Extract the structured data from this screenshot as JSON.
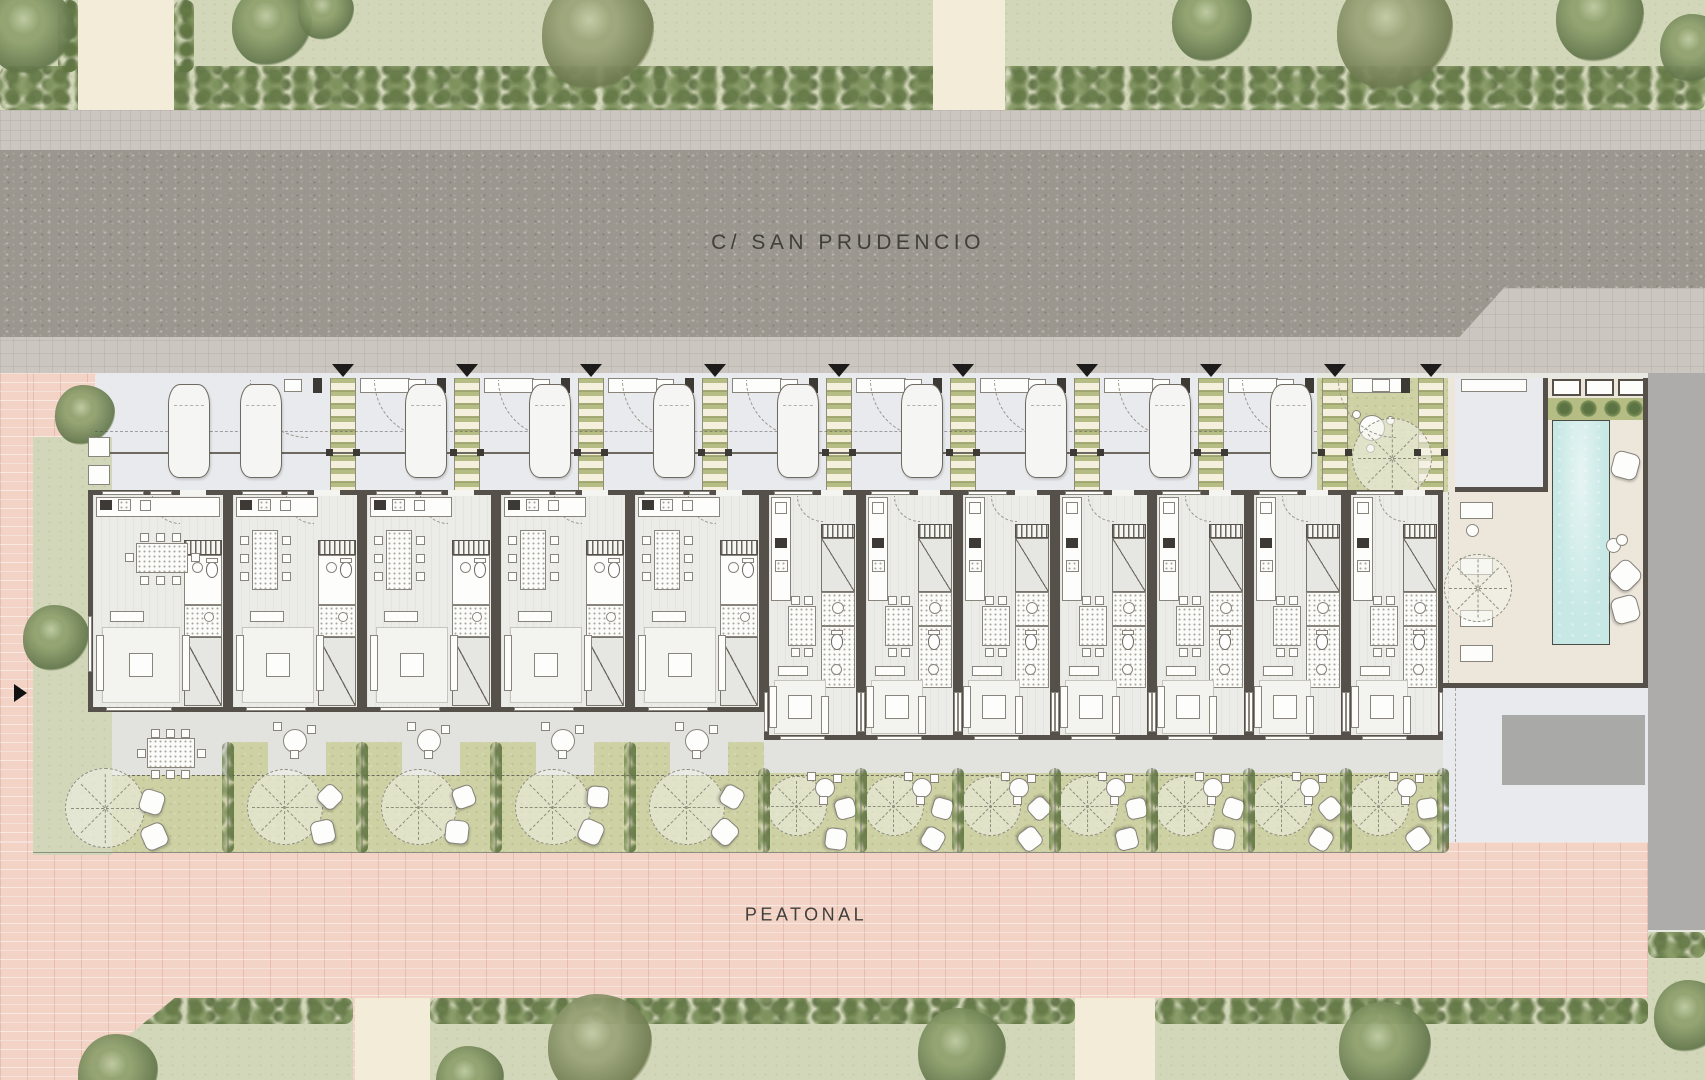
{
  "labels": {
    "street": "C/ SAN PRUDENCIO",
    "pedestrian": "PEATONAL"
  },
  "colors": {
    "street": "#9b968e",
    "sidewalk": "#cbc6bf",
    "pink_paving": "#f3d3c6",
    "lawn": "#d3d7ba",
    "hedge": "#7c905c",
    "path_cream": "#f3ecd8",
    "parking": "#e8eaed",
    "garden": "#cdd1a3",
    "terrace": "#e2e2df",
    "wall": "#56504a",
    "floor": "#ebebe8",
    "pool_water": "#c7e8e5",
    "pool_deck": "#ede7db",
    "side_street": "#adacaa",
    "ramp": "#a9a9a7",
    "ladder_green": "#b6bd84",
    "tree_green": "#8ea06c",
    "tree_olive": "#9aa478"
  },
  "plan": {
    "units": [
      {
        "id": "01",
        "type": "A",
        "x": 88,
        "w": 140,
        "first": true
      },
      {
        "id": "02",
        "type": "A",
        "x": 228,
        "w": 134
      },
      {
        "id": "03",
        "type": "A",
        "x": 362,
        "w": 134
      },
      {
        "id": "04",
        "type": "A",
        "x": 496,
        "w": 134
      },
      {
        "id": "05",
        "type": "A",
        "x": 630,
        "w": 134
      },
      {
        "id": "06",
        "type": "B",
        "x": 764,
        "w": 97
      },
      {
        "id": "07",
        "type": "B",
        "x": 861,
        "w": 97
      },
      {
        "id": "08",
        "type": "B",
        "x": 958,
        "w": 97
      },
      {
        "id": "09",
        "type": "B",
        "x": 1055,
        "w": 97
      },
      {
        "id": "10",
        "type": "B",
        "x": 1152,
        "w": 97
      },
      {
        "id": "11",
        "type": "B",
        "x": 1249,
        "w": 97
      },
      {
        "id": "12",
        "type": "B",
        "x": 1346,
        "w": 97
      }
    ],
    "ladders": [
      330,
      454,
      578,
      702,
      826,
      950,
      1074,
      1198
    ],
    "patio_ladders": [
      1322,
      1418
    ],
    "triangles": [
      343,
      467,
      591,
      715,
      839,
      963,
      1087,
      1211,
      1335,
      1431
    ],
    "cars": [
      168,
      240,
      405,
      529,
      653,
      777,
      901,
      1025,
      1149,
      1270
    ],
    "garage_car": 1477,
    "top_paths": [
      [
        78,
        96
      ],
      [
        933,
        72
      ]
    ],
    "top_trees": [
      [
        30,
        30,
        44,
        "g"
      ],
      [
        272,
        26,
        40,
        "g"
      ],
      [
        326,
        12,
        28,
        "g"
      ],
      [
        598,
        34,
        56,
        "o"
      ],
      [
        1212,
        22,
        40,
        "g"
      ],
      [
        1395,
        32,
        58,
        "o"
      ],
      [
        1600,
        18,
        44,
        "g"
      ],
      [
        1694,
        48,
        34,
        "g"
      ]
    ],
    "bottom_paths": [
      [
        355,
        75
      ],
      [
        1075,
        80
      ]
    ],
    "bottom_trees": [
      [
        600,
        1046,
        52,
        "o"
      ],
      [
        962,
        1052,
        44,
        "g"
      ],
      [
        1385,
        1048,
        46,
        "g"
      ],
      [
        118,
        1074,
        40,
        "g"
      ],
      [
        1690,
        1016,
        36,
        "g"
      ],
      [
        470,
        1080,
        34,
        "g"
      ]
    ],
    "lawn_trees": [
      [
        85,
        415,
        30,
        "g"
      ],
      [
        56,
        638,
        33,
        "g"
      ]
    ],
    "patio": {
      "x": 1317,
      "w": 143,
      "table": [
        1372,
        428
      ],
      "tree": [
        1392,
        458,
        40
      ]
    },
    "pool": {
      "x": 1552,
      "y": 420,
      "w": 58,
      "h": 225
    },
    "pool_pillows": [
      [
        1612,
        452
      ],
      [
        1612,
        562
      ],
      [
        1612,
        596
      ]
    ],
    "pool_loungers": [
      502,
      558,
      610,
      645
    ],
    "deck_tree": [
      1478,
      588,
      34
    ],
    "planter_plants": [
      1556,
      1580,
      1604,
      1626
    ],
    "stepping_bottom": [
      115,
      144,
      173,
      202,
      231
    ],
    "stepping_left": [
      437,
      465,
      493,
      521,
      549,
      577
    ]
  }
}
